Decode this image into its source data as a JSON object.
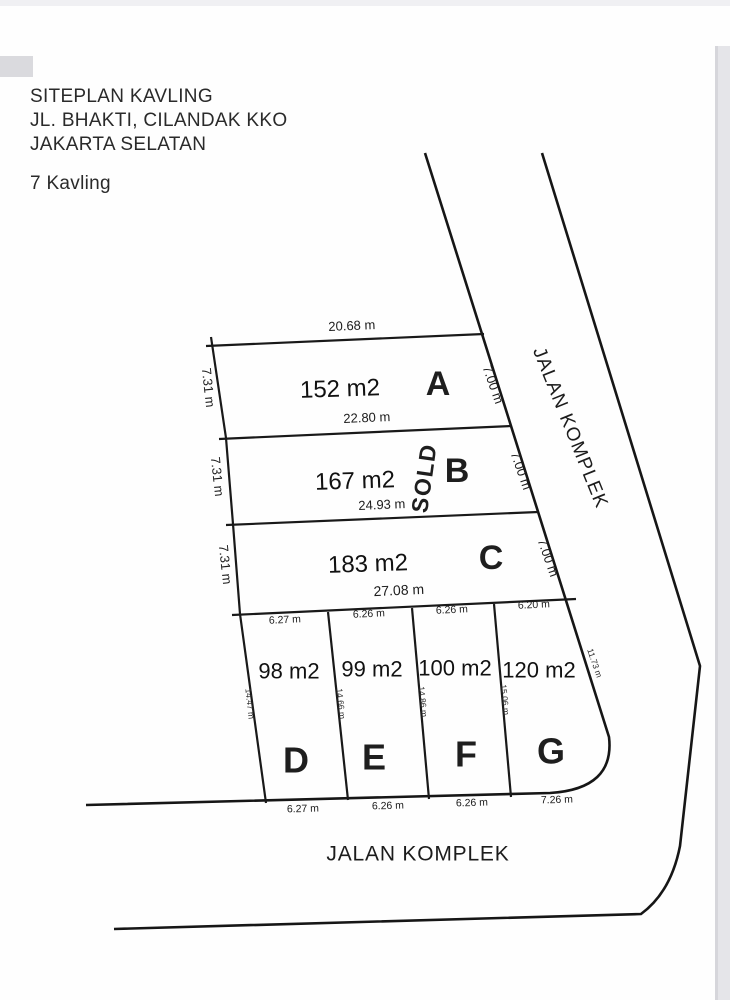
{
  "header": {
    "line1": "SITEPLAN KAVLING",
    "line2": "JL. BHAKTI, CILANDAK KKO",
    "line3": "JAKARTA SELATAN",
    "count": "7 Kavling"
  },
  "roads": {
    "right_label": "JALAN KOMPLEK",
    "bottom_label": "JALAN KOMPLEK"
  },
  "colors": {
    "line": "#191919",
    "plot_letter_red": "#c32027",
    "sold_green": "#3ab43a"
  },
  "plots": [
    {
      "id": "A",
      "area": "152 m2",
      "top": "20.68 m",
      "left": "7.31 m",
      "right": "7.00 m"
    },
    {
      "id": "B",
      "area": "167 m2",
      "top": "22.80 m",
      "left": "7.31 m",
      "right": "7.00 m",
      "status": "SOLD"
    },
    {
      "id": "C",
      "area": "183 m2",
      "top": "24.93 m",
      "left": "7.31 m",
      "right": "7.00 m",
      "bottom": "27.08 m"
    },
    {
      "id": "D",
      "area": "98 m2",
      "top": "6.27 m",
      "left": "14.47 m",
      "bottom": "6.27 m"
    },
    {
      "id": "E",
      "area": "99 m2",
      "top": "6.26 m",
      "left": "14.66 m",
      "bottom": "6.26 m"
    },
    {
      "id": "F",
      "area": "100 m2",
      "top": "6.26 m",
      "left": "14.86 m",
      "bottom": "6.26 m"
    },
    {
      "id": "G",
      "area": "120 m2",
      "top": "6.20 m",
      "left": "15.06 m",
      "right": "11.73 m",
      "bottom": "7.26 m"
    }
  ]
}
